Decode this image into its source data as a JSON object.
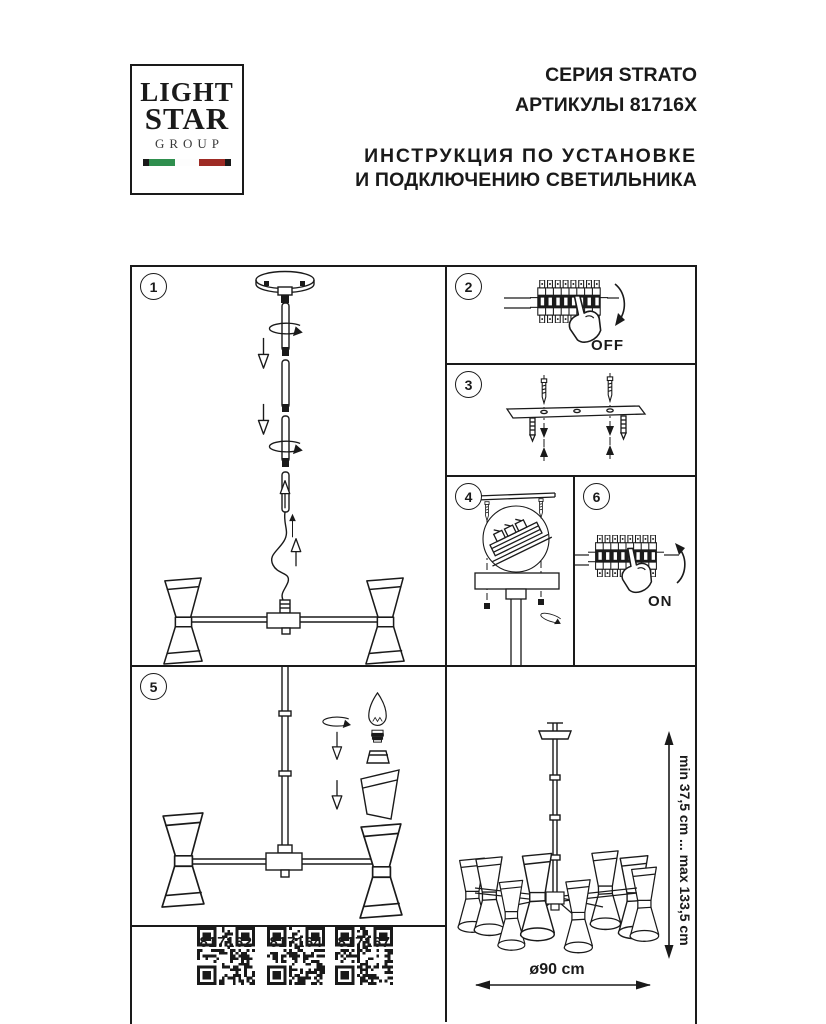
{
  "header": {
    "logo": {
      "line1": "LIGHT",
      "line2": "STAR",
      "line3": "GROUP"
    },
    "series_line1": "СЕРИЯ STRATO",
    "series_line2": "АРТИКУЛЫ 81716X",
    "title_line1": "ИНСТРУКЦИЯ ПО УСТАНОВКЕ",
    "title_line2": "И ПОДКЛЮЧЕНИЮ СВЕТИЛЬНИКА"
  },
  "steps": {
    "step1": {
      "number": "1"
    },
    "step2": {
      "number": "2",
      "switch_label": "OFF"
    },
    "step3": {
      "number": "3"
    },
    "step4": {
      "number": "4"
    },
    "step5": {
      "number": "5"
    },
    "step6": {
      "number": "6",
      "switch_label": "ON"
    }
  },
  "final_view": {
    "height_label": "min 37,5 cm ... max 133,5 cm",
    "diameter_label": "ø90 cm"
  },
  "qr_codes": [
    {
      "label": "817162"
    },
    {
      "label": "817164"
    },
    {
      "label": "817167"
    }
  ],
  "colors": {
    "ink": "#1a1a1a",
    "flag_green": "#2f8f4e",
    "flag_red": "#9e2b25"
  }
}
